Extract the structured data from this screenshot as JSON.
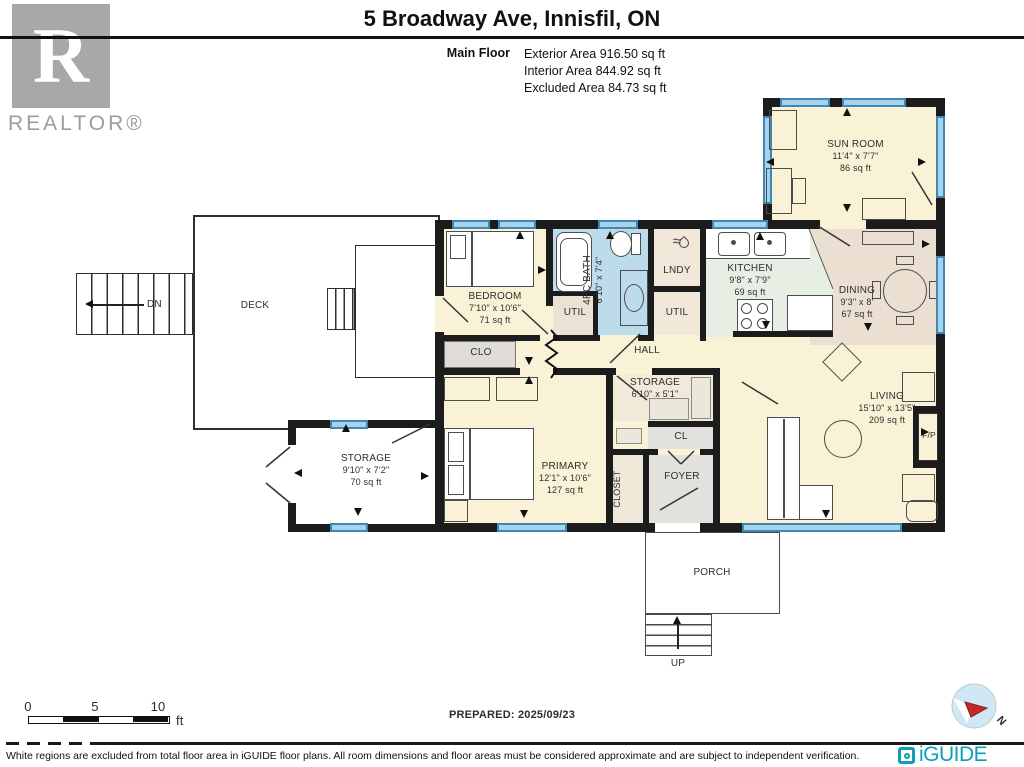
{
  "header": {
    "title": "5 Broadway Ave, Innisfil, ON",
    "floor_label": "Main Floor",
    "stats": [
      "Exterior Area 916.50 sq ft",
      "Interior Area 844.92 sq ft",
      "Excluded Area 84.73 sq ft"
    ],
    "realtor_wordmark": "REALTOR®",
    "realtor_letter": "R"
  },
  "rooms": {
    "sun_room": {
      "name": "SUN ROOM",
      "dims": "11'4\" x 7'7\"",
      "area": "86 sq ft"
    },
    "bedroom": {
      "name": "BEDROOM",
      "dims": "7'10\" x 10'6\"",
      "area": "71 sq ft"
    },
    "bath": {
      "name": "4PC BATH",
      "dims": "6'10\" x 7'4\""
    },
    "lndy": {
      "name": "LNDY"
    },
    "util_bath": {
      "name": "UTIL"
    },
    "util_kitchen": {
      "name": "UTIL"
    },
    "kitchen": {
      "name": "KITCHEN",
      "dims": "9'8\" x 7'9\"",
      "area": "69 sq ft"
    },
    "dining": {
      "name": "DINING",
      "dims": "9'3\" x 8'",
      "area": "67 sq ft"
    },
    "hall": {
      "name": "HALL"
    },
    "clo": {
      "name": "CLO"
    },
    "storage_mid": {
      "name": "STORAGE",
      "dims": "6'10\" x 5'1\""
    },
    "cl": {
      "name": "CL"
    },
    "closet": {
      "name": "CLOSET"
    },
    "foyer": {
      "name": "FOYER"
    },
    "primary": {
      "name": "PRIMARY",
      "dims": "12'1\" x 10'6\"",
      "area": "127 sq ft"
    },
    "living": {
      "name": "LIVING",
      "dims": "15'10\" x 13'5\"",
      "area": "209 sq ft"
    },
    "fireplace": {
      "name": "F/P"
    },
    "deck": {
      "name": "DECK",
      "stair_label": "DN"
    },
    "storage_left": {
      "name": "STORAGE",
      "dims": "9'10\" x 7'2\"",
      "area": "70 sq ft"
    },
    "porch": {
      "name": "PORCH",
      "stair_label": "UP"
    }
  },
  "footer": {
    "scale": {
      "ticks": [
        "0",
        "5",
        "10"
      ],
      "unit": "ft"
    },
    "prepared": "PREPARED: 2025/09/23",
    "compass_label": "N",
    "disclaimer": "White regions are excluded from total floor area in iGUIDE floor plans. All room dimensions and floor areas must be considered approximate and are subject to independent verification.",
    "brand": "iGUIDE"
  },
  "colors": {
    "wall": "#1c1c1c",
    "floor_cream": "#f9f2d6",
    "floor_bath_blue": "#bcdcec",
    "floor_kitchen_green": "#e7efe4",
    "floor_tan": "#eadfd0",
    "floor_gray": "#e3e1de",
    "window_blue": "#a6d3ec",
    "window_frame": "#4187b5",
    "brand_teal": "#0c9fb8",
    "compass_blue": "#cfe8f6",
    "compass_red": "#c22a25",
    "realtor_gray": "#a8a8a8"
  }
}
